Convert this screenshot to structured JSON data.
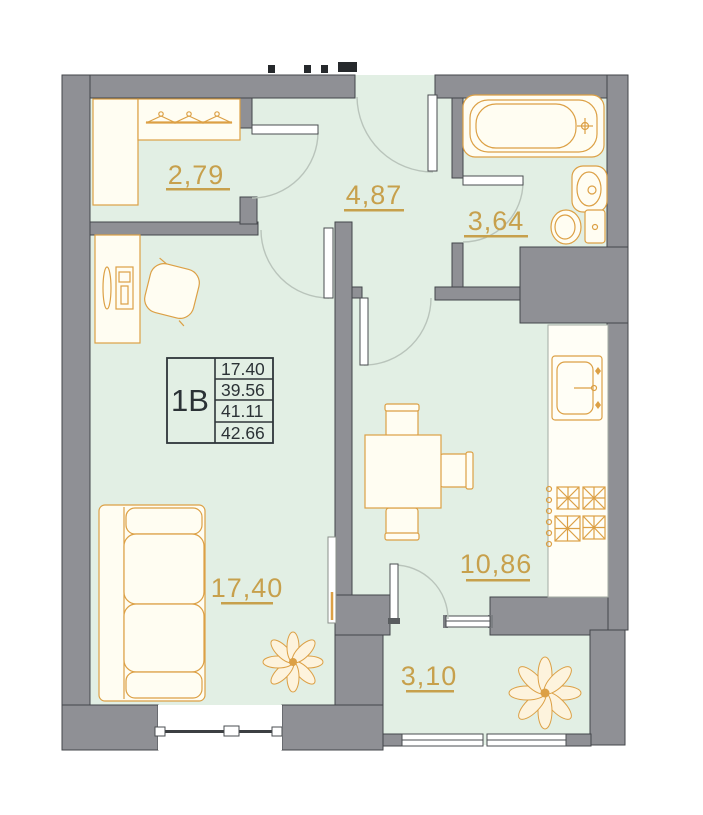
{
  "unit": {
    "code": "1B",
    "areas": [
      "17.40",
      "39.56",
      "41.11",
      "42.66"
    ]
  },
  "rooms": {
    "wardrobe": {
      "area": "2,79"
    },
    "hallway": {
      "area": "4,87"
    },
    "bathroom": {
      "area": "3,64"
    },
    "living": {
      "area": "17,40"
    },
    "kitchen": {
      "area": "10,86"
    },
    "balcony": {
      "area": "3,10"
    }
  },
  "colors": {
    "wall": "#8f9095",
    "wall_outline": "#43464a",
    "floor": "#e2efe4",
    "furniture": "#dca045",
    "label_gold": "#c7a04c",
    "info_text": "#2b3236",
    "background": "#ffffff"
  }
}
